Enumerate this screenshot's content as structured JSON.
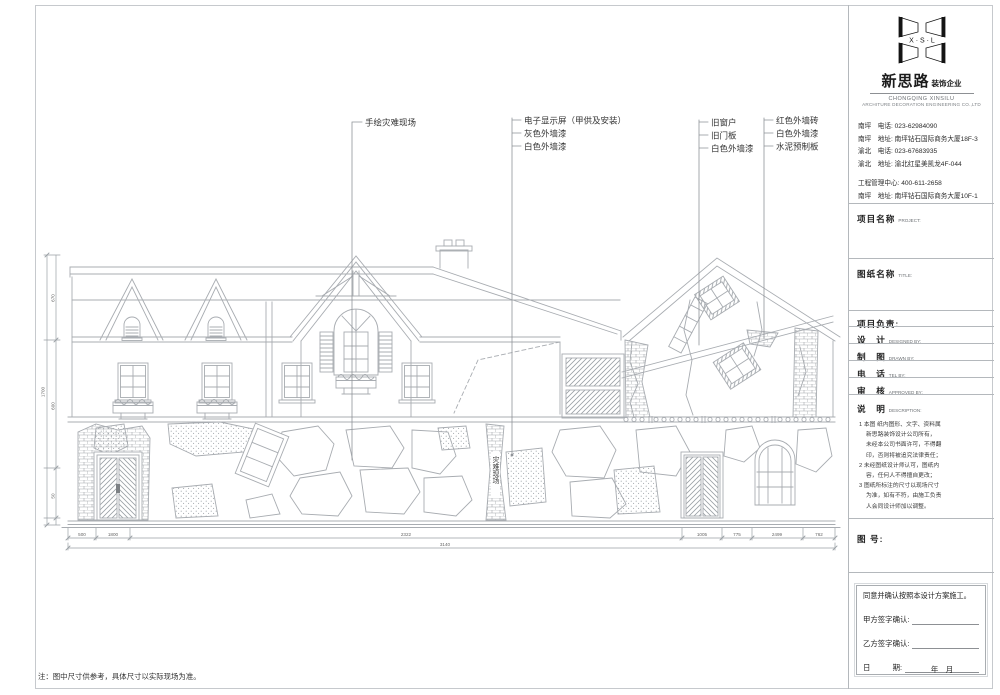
{
  "brand": {
    "logo_letters": "X · S · L",
    "name_cn": "新思路",
    "name_tag": " 装饰企业",
    "name_en1": "CHONGQING XINSILU",
    "name_en2": "ARCHITURE DECORATION ENGINEERING CO.,LTD",
    "contacts": [
      "南坪　电话: 023-62984090",
      "南坪　地址: 南坪钻石国际商务大厦18F-3",
      "渝北　电话: 023-67683935",
      "渝北　地址: 渝北红星美凯龙4F-044",
      "工程管理中心: 400-611-2658",
      "南坪　地址: 南坪钻石国际商务大厦10F-1"
    ]
  },
  "titleblock": {
    "project_cn": "项目名称",
    "project_en": "PROJECT:",
    "sheet_cn": "图纸名称",
    "sheet_en": "TITLE:",
    "leader_cn": "项目负责:",
    "rows": [
      {
        "cn": "设　计",
        "en": "DESIGNED BY:"
      },
      {
        "cn": "制　图",
        "en": "DRAWN BY:"
      },
      {
        "cn": "电　话",
        "en": "TEL BY:"
      },
      {
        "cn": "审　核",
        "en": "APPROVED BY:"
      }
    ],
    "desc_cn": "说　明",
    "desc_en": "DESCRIPTION:",
    "desc_lines": [
      "1 本图 纸内图形、文字、资料属",
      "新思路装饰设计公司所有，",
      "未经本公司书面许可，不得翻",
      "印，否则将被追究法律责任；",
      "2 未经图纸设计师认可，图纸内",
      "容，任何人不得擅自更改；",
      "3 图纸所标注的尺寸以现场尺寸",
      "为准，如有不符，由施工负责",
      "人会同设计师加以调整。"
    ],
    "fig_no_cn": "图 号:"
  },
  "signoff": {
    "agree": "同意并确认按照本设计方案施工。",
    "party_a": "甲方签字确认:",
    "party_b": "乙方签字确认:",
    "date_cn": "日　　　期:",
    "date_line": "年　月"
  },
  "callouts": {
    "g1": [
      "手绘灾难现场"
    ],
    "g2": [
      "电子显示屏（甲供及安装）",
      "灰色外墙漆",
      "白色外墙漆"
    ],
    "g3": [
      "旧窗户",
      "旧门板",
      "白色外墙漆"
    ],
    "g4": [
      "红色外墙砖",
      "白色外墙漆",
      "水泥预制板"
    ]
  },
  "drawing": {
    "vertical_tag": "灾难现场",
    "note": "注：图中尺寸供参考，具体尺寸以实际现场为准。"
  },
  "dimensions": {
    "bottom_segments": [
      "500",
      "1800",
      "2322",
      "1005",
      "775",
      "2499",
      "762"
    ],
    "bottom_total": "3140",
    "left_segments": [
      "670",
      "600",
      "50"
    ],
    "left_total": "1700"
  },
  "colors": {
    "line": "#a8acb1",
    "dark_text": "#333333",
    "logo_black": "#141414"
  }
}
